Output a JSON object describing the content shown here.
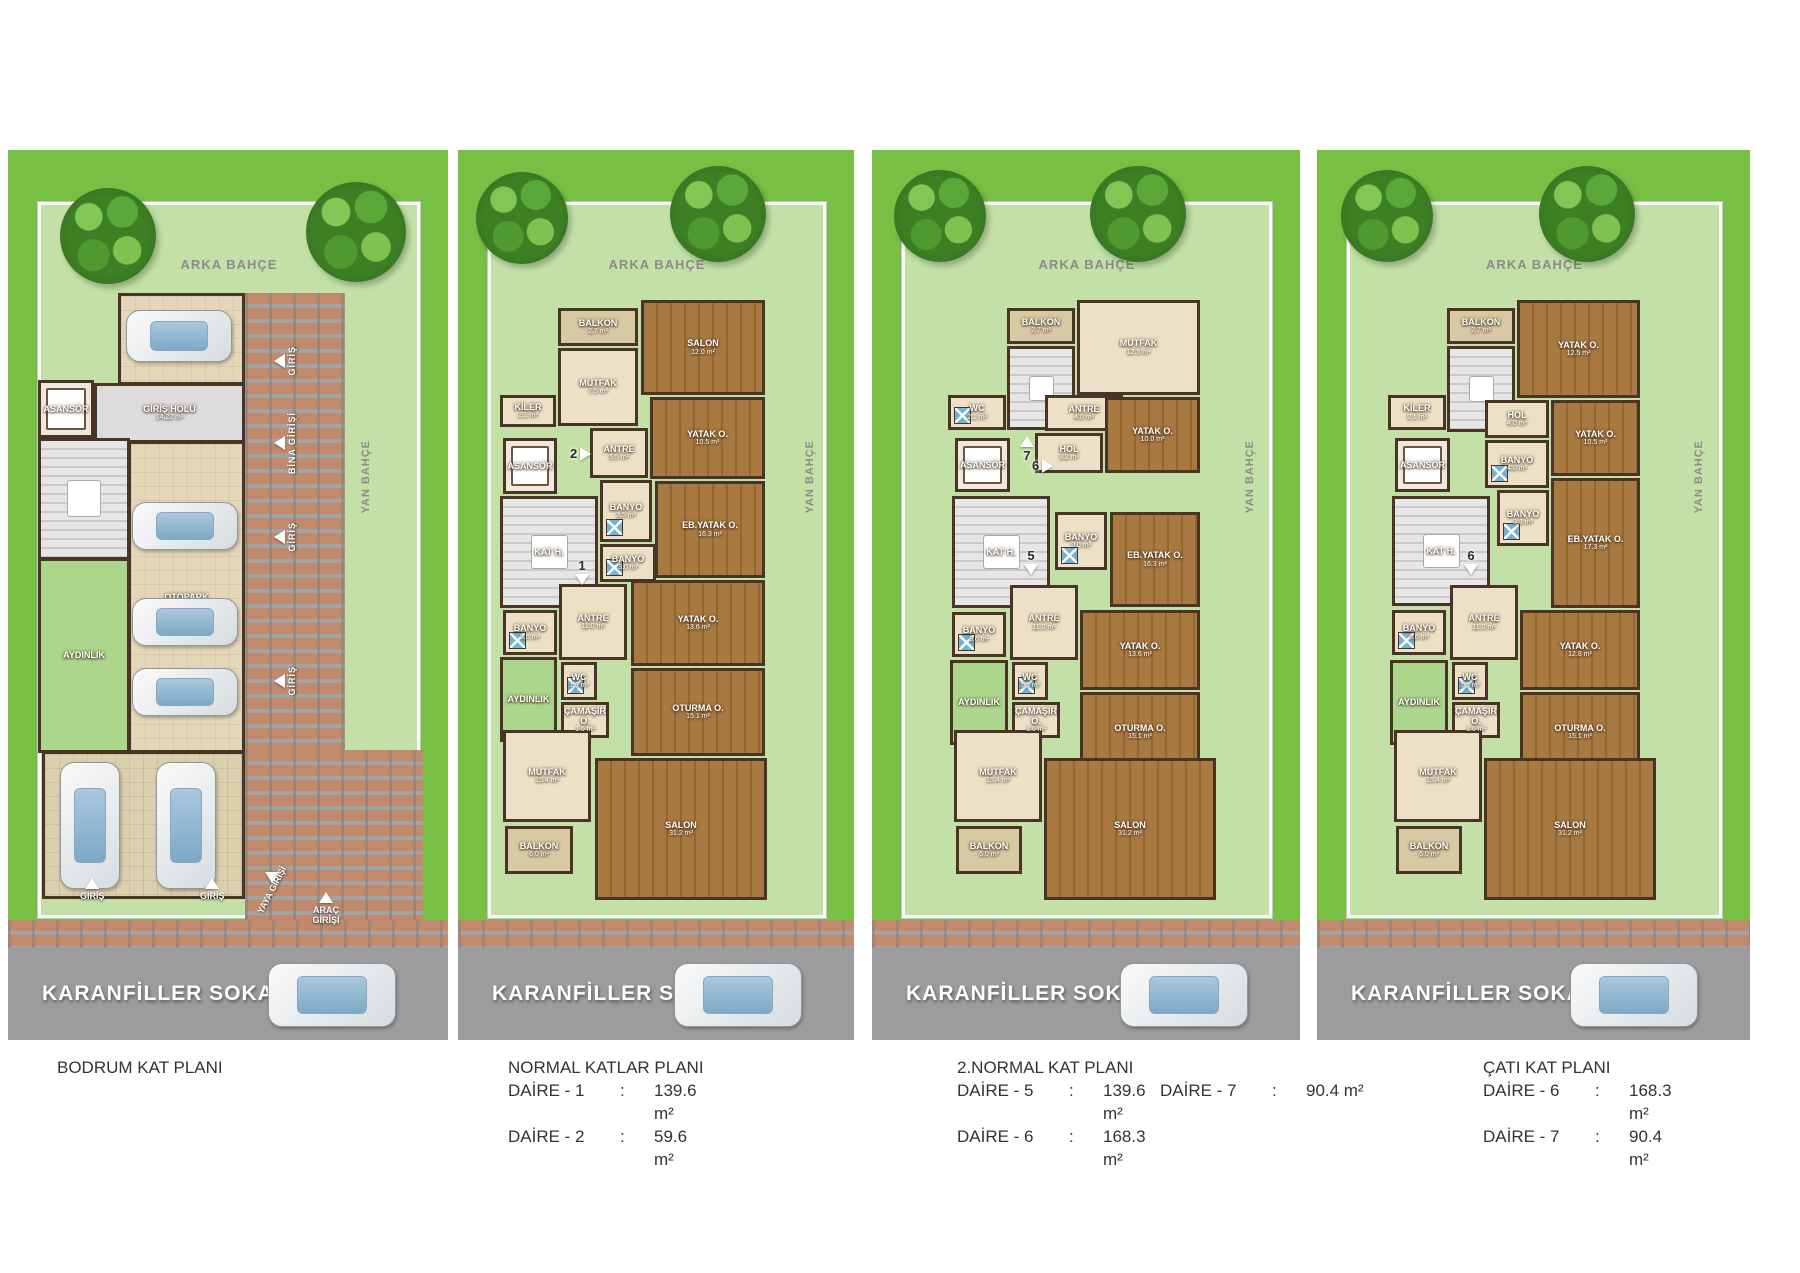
{
  "street": {
    "name": "KARANFİLLER SOKAK"
  },
  "colors": {
    "outer_lawn": "#77c044",
    "garden": "#c3e1a6",
    "street_gray": "#9c9c9c",
    "brick": "#c18a6d",
    "wall": "#4a3426",
    "wood_floor": "#a87a42",
    "tile_floor": "#ece0c6",
    "hall_gray": "#dcdcdc",
    "lightwell_green": "#abd68b",
    "shower_blue": "#6fb3d9",
    "caption_text": "#333333"
  },
  "layout": {
    "top": 150,
    "lawn_h": 770,
    "brick_h": 28,
    "street_h": 92,
    "total_h": 890
  },
  "panels": [
    {
      "id": "bodrum-kat",
      "x": 8,
      "w": 440,
      "arka": "ARKA BAHÇE",
      "trees": [
        {
          "x": 52,
          "y": 38,
          "s": 96
        },
        {
          "x": 298,
          "y": 32,
          "s": 100
        }
      ],
      "bricks": [
        {
          "x": 237,
          "y": 143,
          "w": 100,
          "h": 459
        },
        {
          "x": 237,
          "y": 600,
          "w": 178,
          "h": 170
        }
      ],
      "rooms": [
        {
          "n": "OTOPARK",
          "a": "",
          "t": "park",
          "x": 110,
          "y": 143,
          "w": 127,
          "h": 92
        },
        {
          "n": "ASANSÖR",
          "a": "",
          "t": "elev",
          "x": 30,
          "y": 230,
          "w": 56,
          "h": 58
        },
        {
          "n": "GİRİŞ HOLÜ",
          "a": "14.22 m²",
          "t": "hall",
          "x": 86,
          "y": 233,
          "w": 151,
          "h": 60
        },
        {
          "n": "",
          "a": "",
          "t": "stairs",
          "x": 30,
          "y": 288,
          "w": 92,
          "h": 122
        },
        {
          "n": "OTOPARK",
          "a": "",
          "t": "park",
          "x": 120,
          "y": 291,
          "w": 117,
          "h": 312
        },
        {
          "n": "AYDINLIK",
          "a": "",
          "t": "ayd",
          "x": 30,
          "y": 408,
          "w": 92,
          "h": 195
        },
        {
          "n": "",
          "a": "",
          "t": "park2",
          "x": 34,
          "y": 601,
          "w": 203,
          "h": 148
        }
      ],
      "cars": [
        {
          "x": 118,
          "y": 160,
          "w": 104,
          "h": 50
        },
        {
          "x": 124,
          "y": 352,
          "w": 104,
          "h": 46
        },
        {
          "x": 124,
          "y": 448,
          "w": 104,
          "h": 46
        },
        {
          "x": 124,
          "y": 518,
          "w": 104,
          "h": 46
        },
        {
          "x": 52,
          "y": 612,
          "w": 58,
          "h": 125
        },
        {
          "x": 148,
          "y": 612,
          "w": 58,
          "h": 125
        }
      ],
      "markers": [
        {
          "t": "GİRİŞ",
          "x": 266,
          "y": 196,
          "ar": "left",
          "vert": true
        },
        {
          "t": "BİNA GİRİŞİ",
          "x": 266,
          "y": 262,
          "ar": "left",
          "vert": true
        },
        {
          "t": "GİRİŞ",
          "x": 266,
          "y": 372,
          "ar": "left",
          "vert": true
        },
        {
          "t": "GİRİŞ",
          "x": 266,
          "y": 516,
          "ar": "left",
          "vert": true
        },
        {
          "t": "YAN BAHÇE",
          "x": 352,
          "y": 290,
          "vert": true,
          "gray": true
        },
        {
          "t": "GİRİŞ",
          "x": 72,
          "y": 728,
          "ar": "up"
        },
        {
          "t": "GİRİŞ",
          "x": 192,
          "y": 728,
          "ar": "up"
        },
        {
          "t": "YAYA GİRİŞİ",
          "x": 238,
          "y": 722,
          "ar": "down",
          "rot": -62
        },
        {
          "t": "ARAÇ GİRİŞİ",
          "x": 298,
          "y": 742,
          "ar": "up",
          "wrap": 40
        }
      ],
      "apts": [],
      "caption": {
        "x": 57,
        "y": 1056,
        "title": "BODRUM KAT PLANI",
        "col1": [],
        "col2": []
      }
    },
    {
      "id": "normal-katlar",
      "x": 458,
      "w": 396,
      "arka": "ARKA BAHÇE",
      "trees": [
        {
          "x": 18,
          "y": 22,
          "s": 92
        },
        {
          "x": 212,
          "y": 16,
          "s": 96
        }
      ],
      "bricks": [],
      "rooms": [
        {
          "n": "BALKON",
          "a": "2.7 m²",
          "t": "balk",
          "x": 100,
          "y": 158,
          "w": 80,
          "h": 38
        },
        {
          "n": "SALON",
          "a": "12.0 m²",
          "t": "wood",
          "x": 183,
          "y": 150,
          "w": 124,
          "h": 95
        },
        {
          "n": "MUTFAK",
          "a": "7.5 m²",
          "t": "tile",
          "x": 100,
          "y": 198,
          "w": 80,
          "h": 78
        },
        {
          "n": "KİLER",
          "a": "2.1 m²",
          "t": "tile",
          "x": 42,
          "y": 245,
          "w": 56,
          "h": 32
        },
        {
          "n": "YATAK O.",
          "a": "10.5 m²",
          "t": "wood",
          "x": 192,
          "y": 247,
          "w": 115,
          "h": 82
        },
        {
          "n": "ANTRE",
          "a": "5.5 m²",
          "t": "tile",
          "x": 132,
          "y": 278,
          "w": 58,
          "h": 50
        },
        {
          "n": "ASANSÖR",
          "a": "",
          "t": "elev",
          "x": 45,
          "y": 288,
          "w": 54,
          "h": 56
        },
        {
          "n": "KAT H.",
          "a": "",
          "t": "stairs",
          "x": 42,
          "y": 346,
          "w": 98,
          "h": 112
        },
        {
          "n": "BANYO",
          "a": "3.5 m²",
          "t": "bath",
          "x": 142,
          "y": 330,
          "w": 52,
          "h": 62
        },
        {
          "n": "EB.YATAK O.",
          "a": "16.3 m²",
          "t": "wood",
          "x": 197,
          "y": 331,
          "w": 110,
          "h": 97
        },
        {
          "n": "BANYO",
          "a": "3.0 m²",
          "t": "bath",
          "x": 142,
          "y": 394,
          "w": 56,
          "h": 38
        },
        {
          "n": "BANYO",
          "a": "3.6 m²",
          "t": "bath",
          "x": 45,
          "y": 460,
          "w": 54,
          "h": 45
        },
        {
          "n": "ANTRE",
          "a": "11.0 m²",
          "t": "tile",
          "x": 101,
          "y": 434,
          "w": 68,
          "h": 76
        },
        {
          "n": "WC",
          "a": "1.9 m²",
          "t": "bath",
          "x": 103,
          "y": 512,
          "w": 36,
          "h": 38
        },
        {
          "n": "AYDINLIK",
          "a": "",
          "t": "ayd",
          "x": 42,
          "y": 507,
          "w": 57,
          "h": 85
        },
        {
          "n": "ÇAMAŞIR O.",
          "a": "1.6 m²",
          "t": "tile",
          "x": 103,
          "y": 552,
          "w": 48,
          "h": 36
        },
        {
          "n": "YATAK O.",
          "a": "13.6 m²",
          "t": "wood",
          "x": 173,
          "y": 430,
          "w": 134,
          "h": 86
        },
        {
          "n": "OTURMA O.",
          "a": "15.1 m²",
          "t": "wood",
          "x": 173,
          "y": 518,
          "w": 134,
          "h": 88
        },
        {
          "n": "MUTFAK",
          "a": "15.4 m²",
          "t": "tile",
          "x": 45,
          "y": 580,
          "w": 88,
          "h": 92
        },
        {
          "n": "SALON",
          "a": "31.2 m²",
          "t": "wood",
          "x": 137,
          "y": 608,
          "w": 172,
          "h": 142
        },
        {
          "n": "BALKON",
          "a": "6.0 m²",
          "t": "balk",
          "x": 47,
          "y": 676,
          "w": 68,
          "h": 48
        }
      ],
      "cars": [],
      "markers": [
        {
          "t": "YAN BAHÇE",
          "x": 346,
          "y": 290,
          "vert": true,
          "gray": true
        }
      ],
      "apts": [
        {
          "n": "2",
          "d": "right",
          "x": 112,
          "y": 296
        },
        {
          "n": "1",
          "d": "down",
          "x": 117,
          "y": 408
        }
      ],
      "caption": {
        "x": 508,
        "y": 1056,
        "title": "NORMAL KATLAR PLANI",
        "col1": [
          {
            "l": "DAİRE - 1",
            "v": "139.6 m²"
          },
          {
            "l": "DAİRE - 2",
            "v": "59.6 m²"
          }
        ],
        "col2": []
      }
    },
    {
      "id": "ikinci-normal-kat",
      "x": 872,
      "w": 428,
      "arka": "ARKA BAHÇE",
      "trees": [
        {
          "x": 22,
          "y": 20,
          "s": 92
        },
        {
          "x": 218,
          "y": 16,
          "s": 96
        }
      ],
      "bricks": [],
      "rooms": [
        {
          "n": "BALKON",
          "a": "2.7 m²",
          "t": "balk",
          "x": 135,
          "y": 158,
          "w": 68,
          "h": 36
        },
        {
          "n": "",
          "a": "",
          "t": "stairs",
          "x": 135,
          "y": 196,
          "w": 68,
          "h": 84
        },
        {
          "n": "MUTFAK",
          "a": "12.5 m²",
          "t": "tile",
          "x": 205,
          "y": 150,
          "w": 123,
          "h": 95
        },
        {
          "n": "WC",
          "a": "2.1 m²",
          "t": "bath",
          "x": 76,
          "y": 245,
          "w": 58,
          "h": 35
        },
        {
          "n": "ANTRE",
          "a": "4.0 m²",
          "t": "tile",
          "x": 173,
          "y": 245,
          "w": 78,
          "h": 36
        },
        {
          "n": "HOL",
          "a": "3.2 m²",
          "t": "tile",
          "x": 163,
          "y": 283,
          "w": 68,
          "h": 40
        },
        {
          "n": "YATAK O.",
          "a": "10.0 m²",
          "t": "wood",
          "x": 233,
          "y": 247,
          "w": 95,
          "h": 76
        },
        {
          "n": "ASANSÖR",
          "a": "",
          "t": "elev",
          "x": 83,
          "y": 288,
          "w": 55,
          "h": 54
        },
        {
          "n": "KAT H.",
          "a": "",
          "t": "stairs",
          "x": 80,
          "y": 346,
          "w": 98,
          "h": 112
        },
        {
          "n": "BANYO",
          "a": "3.0 m²",
          "t": "bath",
          "x": 183,
          "y": 362,
          "w": 52,
          "h": 58
        },
        {
          "n": "EB.YATAK O.",
          "a": "16.3 m²",
          "t": "wood",
          "x": 238,
          "y": 362,
          "w": 90,
          "h": 95
        },
        {
          "n": "BANYO",
          "a": "3.6 m²",
          "t": "bath",
          "x": 80,
          "y": 462,
          "w": 54,
          "h": 45
        },
        {
          "n": "ANTRE",
          "a": "11.0 m²",
          "t": "tile",
          "x": 138,
          "y": 435,
          "w": 68,
          "h": 75
        },
        {
          "n": "WC",
          "a": "1.5 m²",
          "t": "bath",
          "x": 140,
          "y": 512,
          "w": 36,
          "h": 38
        },
        {
          "n": "AYDINLIK",
          "a": "",
          "t": "ayd",
          "x": 78,
          "y": 510,
          "w": 58,
          "h": 85
        },
        {
          "n": "ÇAMAŞIR O.",
          "a": "1.6 m²",
          "t": "tile",
          "x": 140,
          "y": 552,
          "w": 48,
          "h": 36
        },
        {
          "n": "YATAK O.",
          "a": "13.6 m²",
          "t": "wood",
          "x": 208,
          "y": 460,
          "w": 120,
          "h": 80
        },
        {
          "n": "OTURMA O.",
          "a": "15.1 m²",
          "t": "wood",
          "x": 208,
          "y": 542,
          "w": 120,
          "h": 80
        },
        {
          "n": "MUTFAK",
          "a": "15.4 m²",
          "t": "tile",
          "x": 82,
          "y": 580,
          "w": 88,
          "h": 92
        },
        {
          "n": "SALON",
          "a": "31.2 m²",
          "t": "wood",
          "x": 172,
          "y": 608,
          "w": 172,
          "h": 142
        },
        {
          "n": "BALKON",
          "a": "6.0 m²",
          "t": "balk",
          "x": 84,
          "y": 676,
          "w": 66,
          "h": 48
        }
      ],
      "cars": [],
      "markers": [
        {
          "t": "YAN BAHÇE",
          "x": 372,
          "y": 290,
          "vert": true,
          "gray": true
        }
      ],
      "apts": [
        {
          "n": "7",
          "d": "up",
          "x": 148,
          "y": 286
        },
        {
          "n": "6",
          "d": "right",
          "x": 160,
          "y": 308
        },
        {
          "n": "5",
          "d": "down",
          "x": 152,
          "y": 398
        }
      ],
      "caption": {
        "x": 957,
        "y": 1056,
        "title": "2.NORMAL KAT PLANI",
        "col1": [
          {
            "l": "DAİRE - 5",
            "v": "139.6 m²"
          },
          {
            "l": "DAİRE - 6",
            "v": "168.3 m²"
          }
        ],
        "col2": [
          {
            "l": "DAİRE - 7",
            "v": "90.4 m²"
          }
        ]
      }
    },
    {
      "id": "cati-kat",
      "x": 1317,
      "w": 433,
      "arka": "ARKA BAHÇE",
      "trees": [
        {
          "x": 24,
          "y": 20,
          "s": 92
        },
        {
          "x": 222,
          "y": 16,
          "s": 96
        }
      ],
      "bricks": [],
      "rooms": [
        {
          "n": "BALKON",
          "a": "2.7 m²",
          "t": "balk",
          "x": 130,
          "y": 158,
          "w": 68,
          "h": 36
        },
        {
          "n": "",
          "a": "",
          "t": "stairs",
          "x": 130,
          "y": 196,
          "w": 68,
          "h": 86
        },
        {
          "n": "YATAK O.",
          "a": "12.5 m²",
          "t": "wood",
          "x": 200,
          "y": 150,
          "w": 123,
          "h": 98
        },
        {
          "n": "KİLER",
          "a": "2.1 m²",
          "t": "tile",
          "x": 71,
          "y": 245,
          "w": 58,
          "h": 35
        },
        {
          "n": "HOL",
          "a": "4.0 m²",
          "t": "tile",
          "x": 168,
          "y": 250,
          "w": 64,
          "h": 38
        },
        {
          "n": "YATAK O.",
          "a": "10.5 m²",
          "t": "wood",
          "x": 234,
          "y": 250,
          "w": 89,
          "h": 76
        },
        {
          "n": "BANYO",
          "a": "4.0 m²",
          "t": "bath",
          "x": 168,
          "y": 290,
          "w": 64,
          "h": 48
        },
        {
          "n": "ASANSÖR",
          "a": "",
          "t": "elev",
          "x": 78,
          "y": 288,
          "w": 55,
          "h": 54
        },
        {
          "n": "KAT H.",
          "a": "",
          "t": "stairs",
          "x": 75,
          "y": 346,
          "w": 98,
          "h": 110
        },
        {
          "n": "BANYO",
          "a": "3.3 m²",
          "t": "bath",
          "x": 180,
          "y": 340,
          "w": 52,
          "h": 56
        },
        {
          "n": "EB.YATAK O.",
          "a": "17.3 m²",
          "t": "wood",
          "x": 234,
          "y": 328,
          "w": 89,
          "h": 130
        },
        {
          "n": "BANYO",
          "a": "3.6 m²",
          "t": "bath",
          "x": 75,
          "y": 460,
          "w": 54,
          "h": 45
        },
        {
          "n": "ANTRE",
          "a": "11.0 m²",
          "t": "tile",
          "x": 133,
          "y": 435,
          "w": 68,
          "h": 75
        },
        {
          "n": "WC",
          "a": "1.5 m²",
          "t": "bath",
          "x": 135,
          "y": 512,
          "w": 36,
          "h": 38
        },
        {
          "n": "AYDINLIK",
          "a": "",
          "t": "ayd",
          "x": 73,
          "y": 510,
          "w": 58,
          "h": 85
        },
        {
          "n": "ÇAMAŞIR O.",
          "a": "1.6 m²",
          "t": "tile",
          "x": 135,
          "y": 552,
          "w": 48,
          "h": 36
        },
        {
          "n": "YATAK O.",
          "a": "12.8 m²",
          "t": "wood",
          "x": 203,
          "y": 460,
          "w": 120,
          "h": 80
        },
        {
          "n": "OTURMA O.",
          "a": "15.1 m²",
          "t": "wood",
          "x": 203,
          "y": 542,
          "w": 120,
          "h": 80
        },
        {
          "n": "MUTFAK",
          "a": "15.4 m²",
          "t": "tile",
          "x": 77,
          "y": 580,
          "w": 88,
          "h": 92
        },
        {
          "n": "SALON",
          "a": "31.2 m²",
          "t": "wood",
          "x": 167,
          "y": 608,
          "w": 172,
          "h": 142
        },
        {
          "n": "BALKON",
          "a": "6.0 m²",
          "t": "balk",
          "x": 79,
          "y": 676,
          "w": 66,
          "h": 48
        }
      ],
      "cars": [],
      "markers": [
        {
          "t": "YAN BAHÇE",
          "x": 376,
          "y": 290,
          "vert": true,
          "gray": true
        }
      ],
      "apts": [
        {
          "n": "6",
          "d": "down",
          "x": 147,
          "y": 398
        }
      ],
      "caption": {
        "x": 1483,
        "y": 1056,
        "title": "ÇATI KAT PLANI",
        "col1": [
          {
            "l": "DAİRE - 6",
            "v": "168.3 m²"
          },
          {
            "l": "DAİRE - 7",
            "v": "90.4 m²"
          }
        ],
        "col2": []
      }
    }
  ]
}
